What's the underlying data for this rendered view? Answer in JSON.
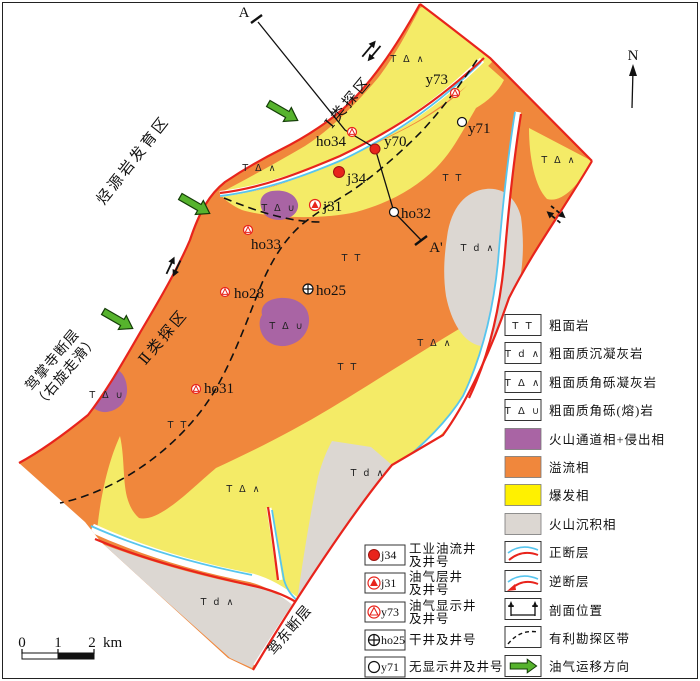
{
  "colors": {
    "effusive_orange": "#F0873C",
    "explosive_yellow_map": "#F4EB67",
    "explosive_yellow_legend": "#FFF100",
    "conduit_purple": "#A964A4",
    "volcano_sedimentary_gray": "#DCD7D2",
    "fault_red": "#E8241C",
    "stream_blue": "#57C5EE",
    "migration_green": "#56B32D"
  },
  "map": {
    "north_label": "N",
    "section": {
      "start_label": "A",
      "end_label": "A'"
    },
    "scale_bar": {
      "tick0": "0",
      "tick1": "1",
      "tick2": "2",
      "unit": "km"
    },
    "area_labels": {
      "source_rock_zone": "烃源岩发育区",
      "class1_zone": "Ⅰ类探区",
      "class2_zone": "Ⅱ类探区",
      "jiazhangsi_fault_name": "驾掌寺断层",
      "jiazhangsi_fault_note": "（右旋走滑）",
      "jiadong_fault_name": "驾东断层"
    },
    "rock_codes": {
      "trachyte": "T T",
      "tuffite": "T d ∧",
      "breccia_tuff": "T Δ ∧",
      "breccia_lava": "T Δ ∪"
    },
    "wells": [
      {
        "id": "ho34",
        "type": "oil-gas-show"
      },
      {
        "id": "y70",
        "type": "industrial-oil"
      },
      {
        "id": "y73",
        "type": "oil-gas-show"
      },
      {
        "id": "y71",
        "type": "no-show"
      },
      {
        "id": "j34",
        "type": "industrial-oil"
      },
      {
        "id": "j31",
        "type": "oil-gas-layer"
      },
      {
        "id": "ho32",
        "type": "no-show"
      },
      {
        "id": "ho33",
        "type": "oil-gas-show"
      },
      {
        "id": "ho28",
        "type": "oil-gas-show"
      },
      {
        "id": "ho25",
        "type": "dry"
      },
      {
        "id": "ho31",
        "type": "oil-gas-show"
      }
    ]
  },
  "legend": {
    "facies": [
      {
        "symbol": "T T",
        "label": "粗面岩",
        "kind": "code"
      },
      {
        "symbol": "T d ∧",
        "label": "粗面质沉凝灰岩",
        "kind": "code"
      },
      {
        "symbol": "T Δ ∧",
        "label": "粗面质角砾凝灰岩",
        "kind": "code"
      },
      {
        "symbol": "T Δ ∪",
        "label": "粗面质角砾(熔)岩",
        "kind": "code"
      },
      {
        "label": "火山通道相+侵出相",
        "kind": "swatch",
        "color": "#A964A4"
      },
      {
        "label": "溢流相",
        "kind": "swatch",
        "color": "#F0873C"
      },
      {
        "label": "爆发相",
        "kind": "swatch",
        "color": "#FFF100"
      },
      {
        "label": "火山沉积相",
        "kind": "swatch",
        "color": "#DCD7D2"
      },
      {
        "label": "正断层",
        "kind": "normal-fault"
      },
      {
        "label": "逆断层",
        "kind": "reverse-fault"
      },
      {
        "label": "剖面位置",
        "kind": "section-location"
      },
      {
        "label": "有利勘探区带",
        "kind": "favorable-zone"
      },
      {
        "label": "油气运移方向",
        "kind": "migration-direction"
      }
    ],
    "wells": [
      {
        "id": "j34",
        "label_line1": "工业油流井",
        "label_line2": "及井号"
      },
      {
        "id": "j31",
        "label_line1": "油气层井",
        "label_line2": "及井号"
      },
      {
        "id": "y73",
        "label_line1": "油气显示井",
        "label_line2": "及井号"
      },
      {
        "id": "ho25",
        "label_line1": "干井及井号",
        "label_line2": ""
      },
      {
        "id": "y71",
        "label_line1": "无显示井及井号",
        "label_line2": ""
      }
    ]
  }
}
